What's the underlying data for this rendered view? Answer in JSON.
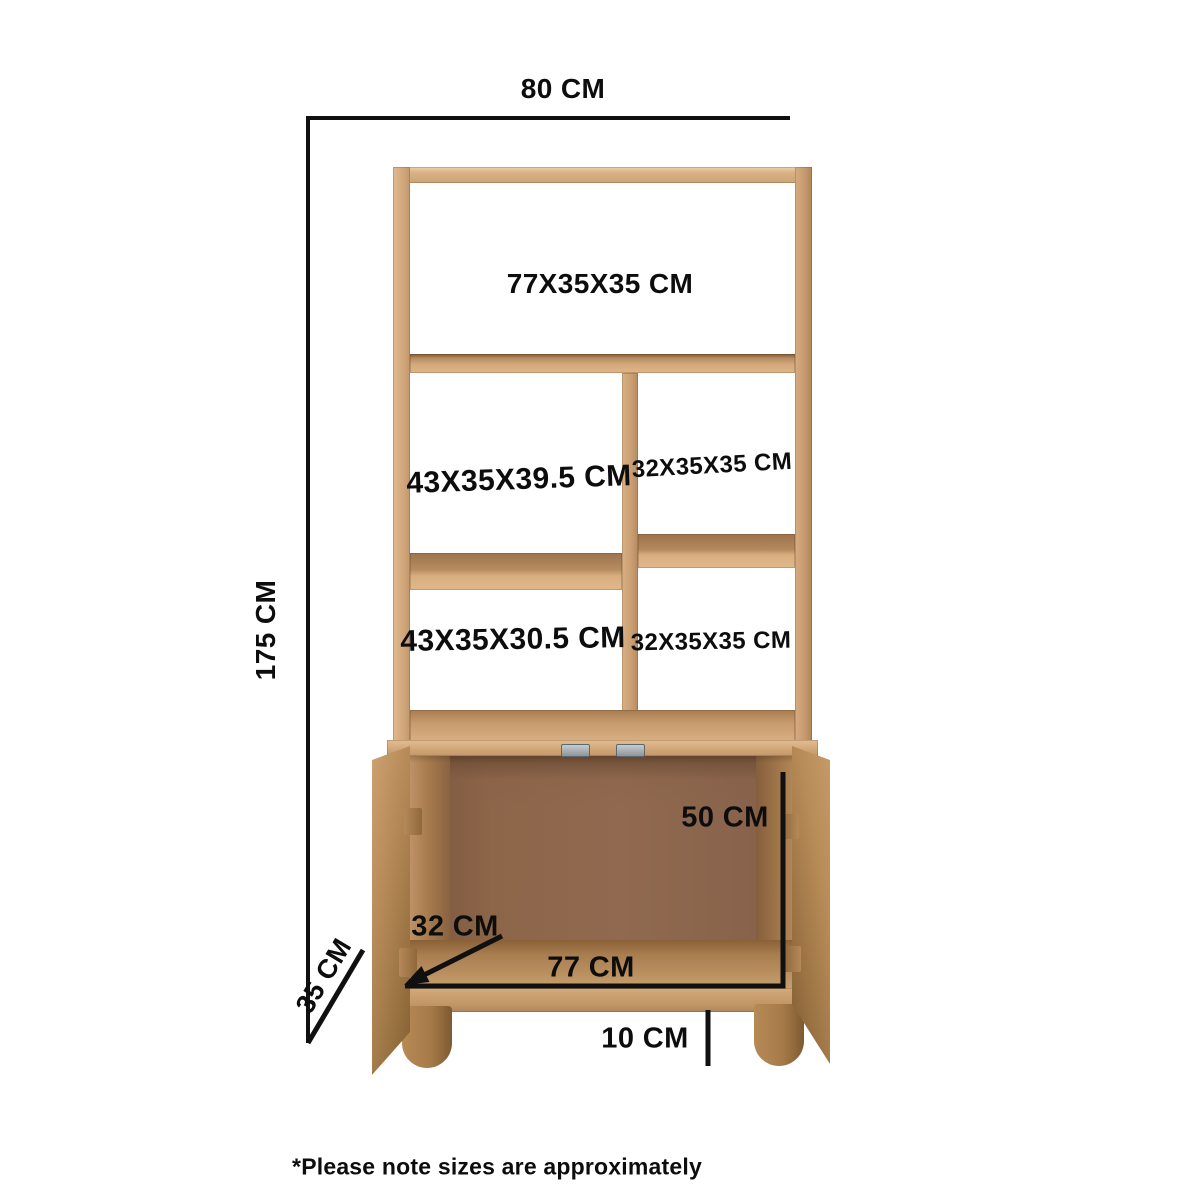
{
  "diagram": {
    "overall_width": "80 CM",
    "overall_height": "175 CM",
    "overall_depth": "35 CM",
    "shelves": {
      "top": "77X35X35 CM",
      "middle_left": "43X35X39.5 CM",
      "middle_right": "32X35X35 CM",
      "bottom_left": "43X35X30.5 CM",
      "bottom_right": "32X35X35 CM"
    },
    "cabinet": {
      "interior_height": "50 CM",
      "interior_width": "77 CM",
      "interior_depth": "32 CM",
      "leg_height": "10 CM"
    },
    "footnote": "*Please note sizes are approximately",
    "colors": {
      "dimension_line": "#101010",
      "wood_light": "#dcb385",
      "wood_mid": "#b98e5e",
      "wood_dark": "#8a6136",
      "interior_back": "#8b6349",
      "hinge_metal": "#9aa1a6"
    }
  }
}
